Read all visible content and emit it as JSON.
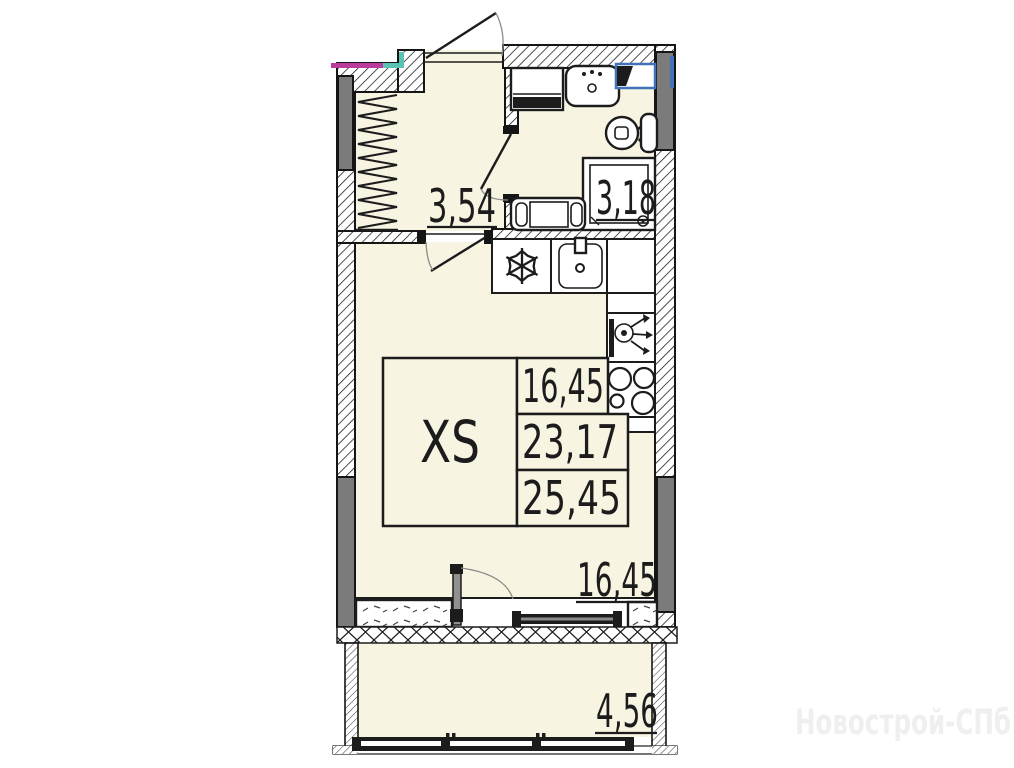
{
  "floor_plan": {
    "unit_type": "XS",
    "area_table": {
      "unit_type_label": "XS",
      "values": [
        "16,45",
        "23,17",
        "25,45"
      ]
    },
    "room_areas": {
      "hallway": "3,54",
      "bathroom": "3,18",
      "living_room": "16,45",
      "balcony": "4,56"
    },
    "fixtures": [
      "entrance-door",
      "wardrobe",
      "washing-machine",
      "bathroom-sink",
      "ventilation-duct",
      "toilet",
      "shower",
      "bathtub",
      "fridge",
      "kitchen-sink",
      "faucet",
      "hob",
      "interior-door",
      "balcony-door",
      "window",
      "balcony-glazing"
    ],
    "colors": {
      "floor": "#f8f4e2",
      "lines": "#1c1c1c",
      "column_gray": "#7b7b7b",
      "accent_blue": "#4273b8",
      "accent_teal": "#5ac2b2",
      "accent_magenta": "#bb3a9e",
      "watermark_gray": "#f0efef"
    }
  },
  "watermark": {
    "text": "Новострой-СПб"
  }
}
